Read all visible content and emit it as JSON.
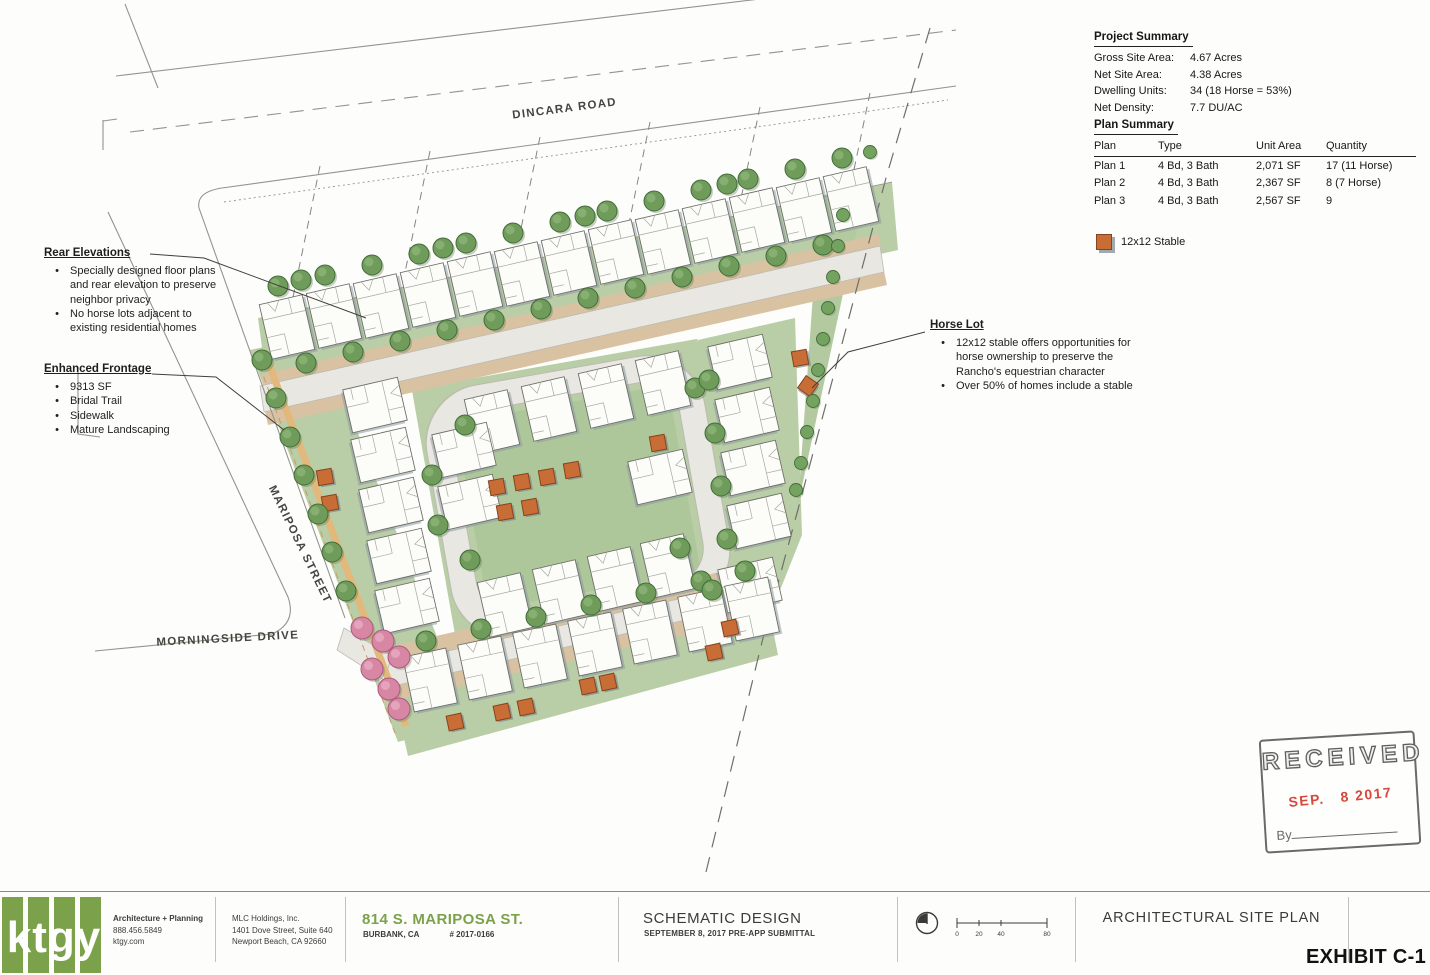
{
  "streets": {
    "north": "DINCARA ROAD",
    "west": "MARIPOSA STREET",
    "south": "MORNINGSIDE DRIVE"
  },
  "project_summary": {
    "title": "Project Summary",
    "rows": [
      {
        "label": "Gross Site Area:",
        "value": "4.67 Acres"
      },
      {
        "label": "Net Site Area:",
        "value": "4.38 Acres"
      },
      {
        "label": "Dwelling Units:",
        "value": "34 (18 Horse = 53%)"
      },
      {
        "label": "Net Density:",
        "value": "7.7 DU/AC"
      }
    ]
  },
  "plan_summary": {
    "title": "Plan Summary",
    "columns": [
      "Plan",
      "Type",
      "Unit Area",
      "Quantity"
    ],
    "rows": [
      [
        "Plan 1",
        "4 Bd, 3 Bath",
        "2,071 SF",
        "17 (11 Horse)"
      ],
      [
        "Plan 2",
        "4 Bd, 3 Bath",
        "2,367 SF",
        "8 (7 Horse)"
      ],
      [
        "Plan 3",
        "4 Bd, 3 Bath",
        "2,567 SF",
        "9"
      ]
    ]
  },
  "legend": {
    "stable_label": "12x12 Stable"
  },
  "annotations": {
    "rear_elevations": {
      "title": "Rear Elevations",
      "bullets": [
        "Specially designed floor plans and rear elevation to preserve neighbor privacy",
        "No horse lots adjacent to existing residential homes"
      ]
    },
    "enhanced_frontage": {
      "title": "Enhanced Frontage",
      "bullets": [
        "9313 SF",
        "Bridal Trail",
        "Sidewalk",
        "Mature Landscaping"
      ]
    },
    "horse_lot": {
      "title": "Horse Lot",
      "bullets": [
        "12x12 stable offers opportunities for horse ownership to preserve the Rancho's equestrian character",
        "Over 50% of homes include a stable"
      ]
    }
  },
  "stamp": {
    "title": "RECEIVED",
    "date": "SEP.   8 2017",
    "by_label": "By"
  },
  "titleblock": {
    "firm": {
      "logo_text": "ktgy",
      "name_label": "Architecture + Planning",
      "phone": "888.456.5849",
      "website": "ktgy.com"
    },
    "client": {
      "name": "MLC Holdings, Inc.",
      "address1": "1401 Dove Street, Suite 640",
      "address2": "Newport Beach, CA 92660"
    },
    "project": {
      "title": "814 S. MARIPOSA ST.",
      "city": "BURBANK, CA",
      "number": "# 2017-0166"
    },
    "phase": {
      "title": "SCHEMATIC DESIGN",
      "subtitle": "SEPTEMBER 8, 2017 PRE-APP SUBMITTAL"
    },
    "sheet": {
      "title": "ARCHITECTURAL SITE PLAN"
    },
    "exhibit": "EXHIBIT C-1",
    "scale": {
      "ticks": [
        "0",
        "20",
        "40",
        "80"
      ]
    }
  },
  "colors": {
    "logo_green": "#7ba24a",
    "stable_orange": "#c96d36",
    "stamp_red": "#d6473c",
    "site_green": "#b9cda6",
    "trail_tan": "#d9c2a2"
  }
}
